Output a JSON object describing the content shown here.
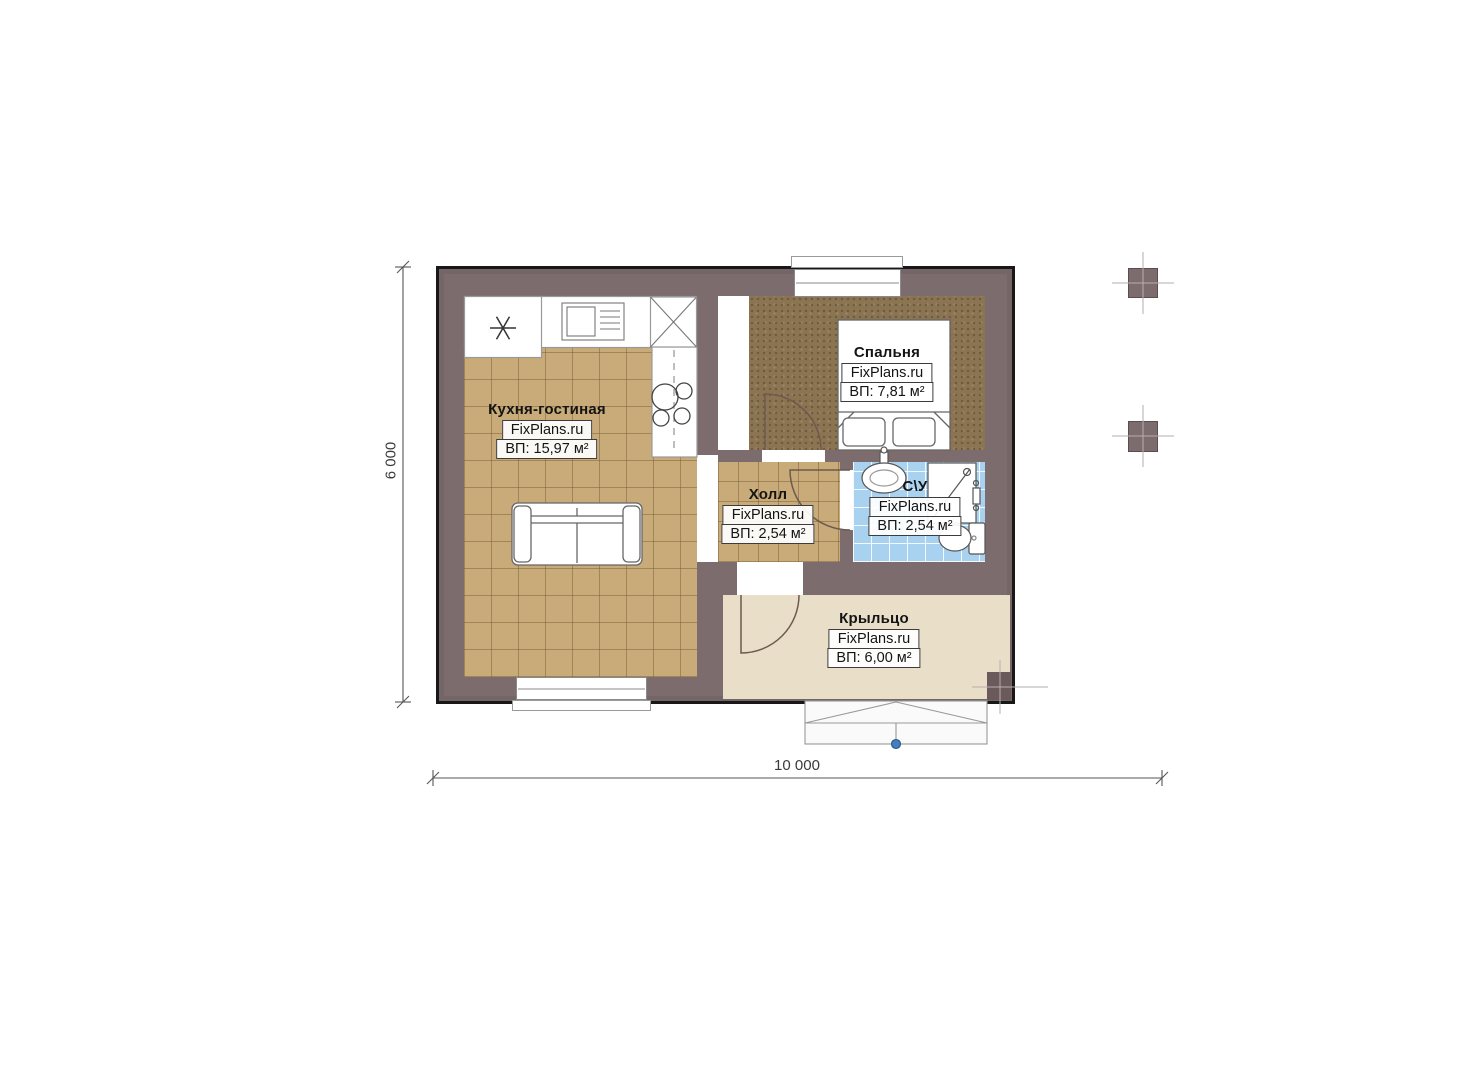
{
  "plan": {
    "rooms": [
      {
        "name": "kitchen-living",
        "title": "Кухня-гостиная",
        "brand": "FixPlans.ru",
        "area": "ВП: 15,97 м²"
      },
      {
        "name": "bedroom",
        "title": "Спальня",
        "brand": "FixPlans.ru",
        "area": "ВП: 7,81 м²"
      },
      {
        "name": "hall",
        "title": "Холл",
        "brand": "FixPlans.ru",
        "area": "ВП: 2,54 м²"
      },
      {
        "name": "bathroom",
        "title": "С\\У",
        "brand": "FixPlans.ru",
        "area": "ВП: 2,54 м²"
      },
      {
        "name": "porch",
        "title": "Крыльцо",
        "brand": "FixPlans.ru",
        "area": "ВП: 6,00 м²"
      }
    ],
    "dimensions": {
      "width": "10 000",
      "height": "6 000"
    },
    "colors": {
      "wall": "#7c6c6d",
      "outline": "#181818",
      "tile_floor": "#c9aa79",
      "bedroom_floor": "#8b7452",
      "bathroom_floor": "#a8d2ef",
      "porch_floor": "#e9dfc9",
      "entrance_marker": "#3f7fc4"
    }
  }
}
